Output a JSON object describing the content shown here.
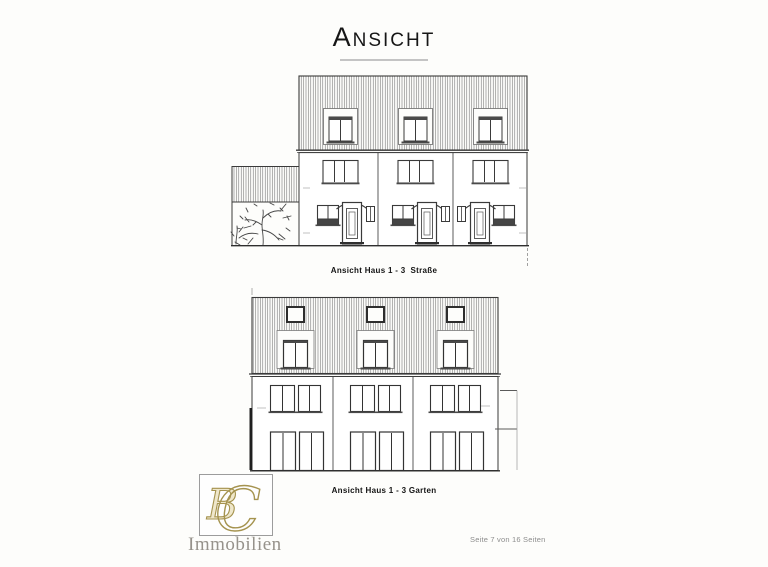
{
  "page": {
    "title": "Ansicht",
    "footer": "Seite 7 von 16 Seiten"
  },
  "drawings": {
    "street": {
      "caption": "Ansicht Haus 1 - 3  Straße"
    },
    "garden": {
      "caption": "Ansicht Haus 1 - 3 Garten"
    }
  },
  "logo": {
    "monogram_left": "B",
    "monogram_right": "C",
    "wordmark": "Immobilien"
  },
  "colors": {
    "ink": "#3a3a3a",
    "hatch": "#6a6a6a",
    "caption_text": "#141414",
    "title_underline": "#c4c4c4",
    "logo_gold_stroke": "#a5934f",
    "logo_gold_fill": "#efe7cb",
    "logo_wordmark_gray": "#96928b",
    "footer_gray": "#8d8d8d",
    "paper": "#fdfdfb"
  }
}
